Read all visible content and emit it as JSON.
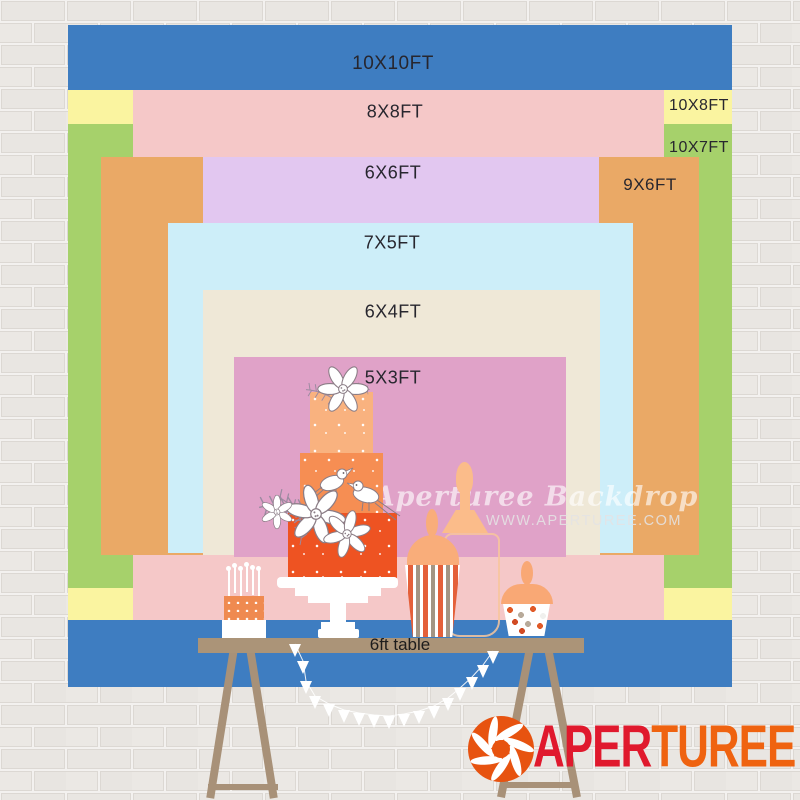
{
  "page": {
    "type": "backdrop-size-comparison-chart"
  },
  "sizes": [
    {
      "id": "10x10",
      "label": "10X10FT",
      "color": "#3e7dc1"
    },
    {
      "id": "10x8",
      "label": "10X8FT",
      "color": "#faf4a0"
    },
    {
      "id": "10x7",
      "label": "10X7FT",
      "color": "#a6d16b"
    },
    {
      "id": "8x8",
      "label": "8X8FT",
      "color": "#f5c8c8"
    },
    {
      "id": "9x6",
      "label": "9X6FT",
      "color": "#eaa966"
    },
    {
      "id": "6x6",
      "label": "6X6FT",
      "color": "#e2c7f0"
    },
    {
      "id": "7x5",
      "label": "7X5FT",
      "color": "#cdeef9"
    },
    {
      "id": "6x4",
      "label": "6X4FT",
      "color": "#efe8d7"
    },
    {
      "id": "5x3",
      "label": "5X3FT",
      "color": "#e0a2c8"
    }
  ],
  "table_label": "6ft table",
  "watermark": {
    "line1": "Aperturee Backdrop",
    "line2": "WWW.APERTUREE.COM"
  },
  "logo": {
    "icon": "aperture-shutter-icon",
    "text_primary": "APER",
    "text_secondary": "TUREE",
    "primary_color": "#e0192d",
    "secondary_color": "#ef6310",
    "icon_color": "#e75310"
  }
}
